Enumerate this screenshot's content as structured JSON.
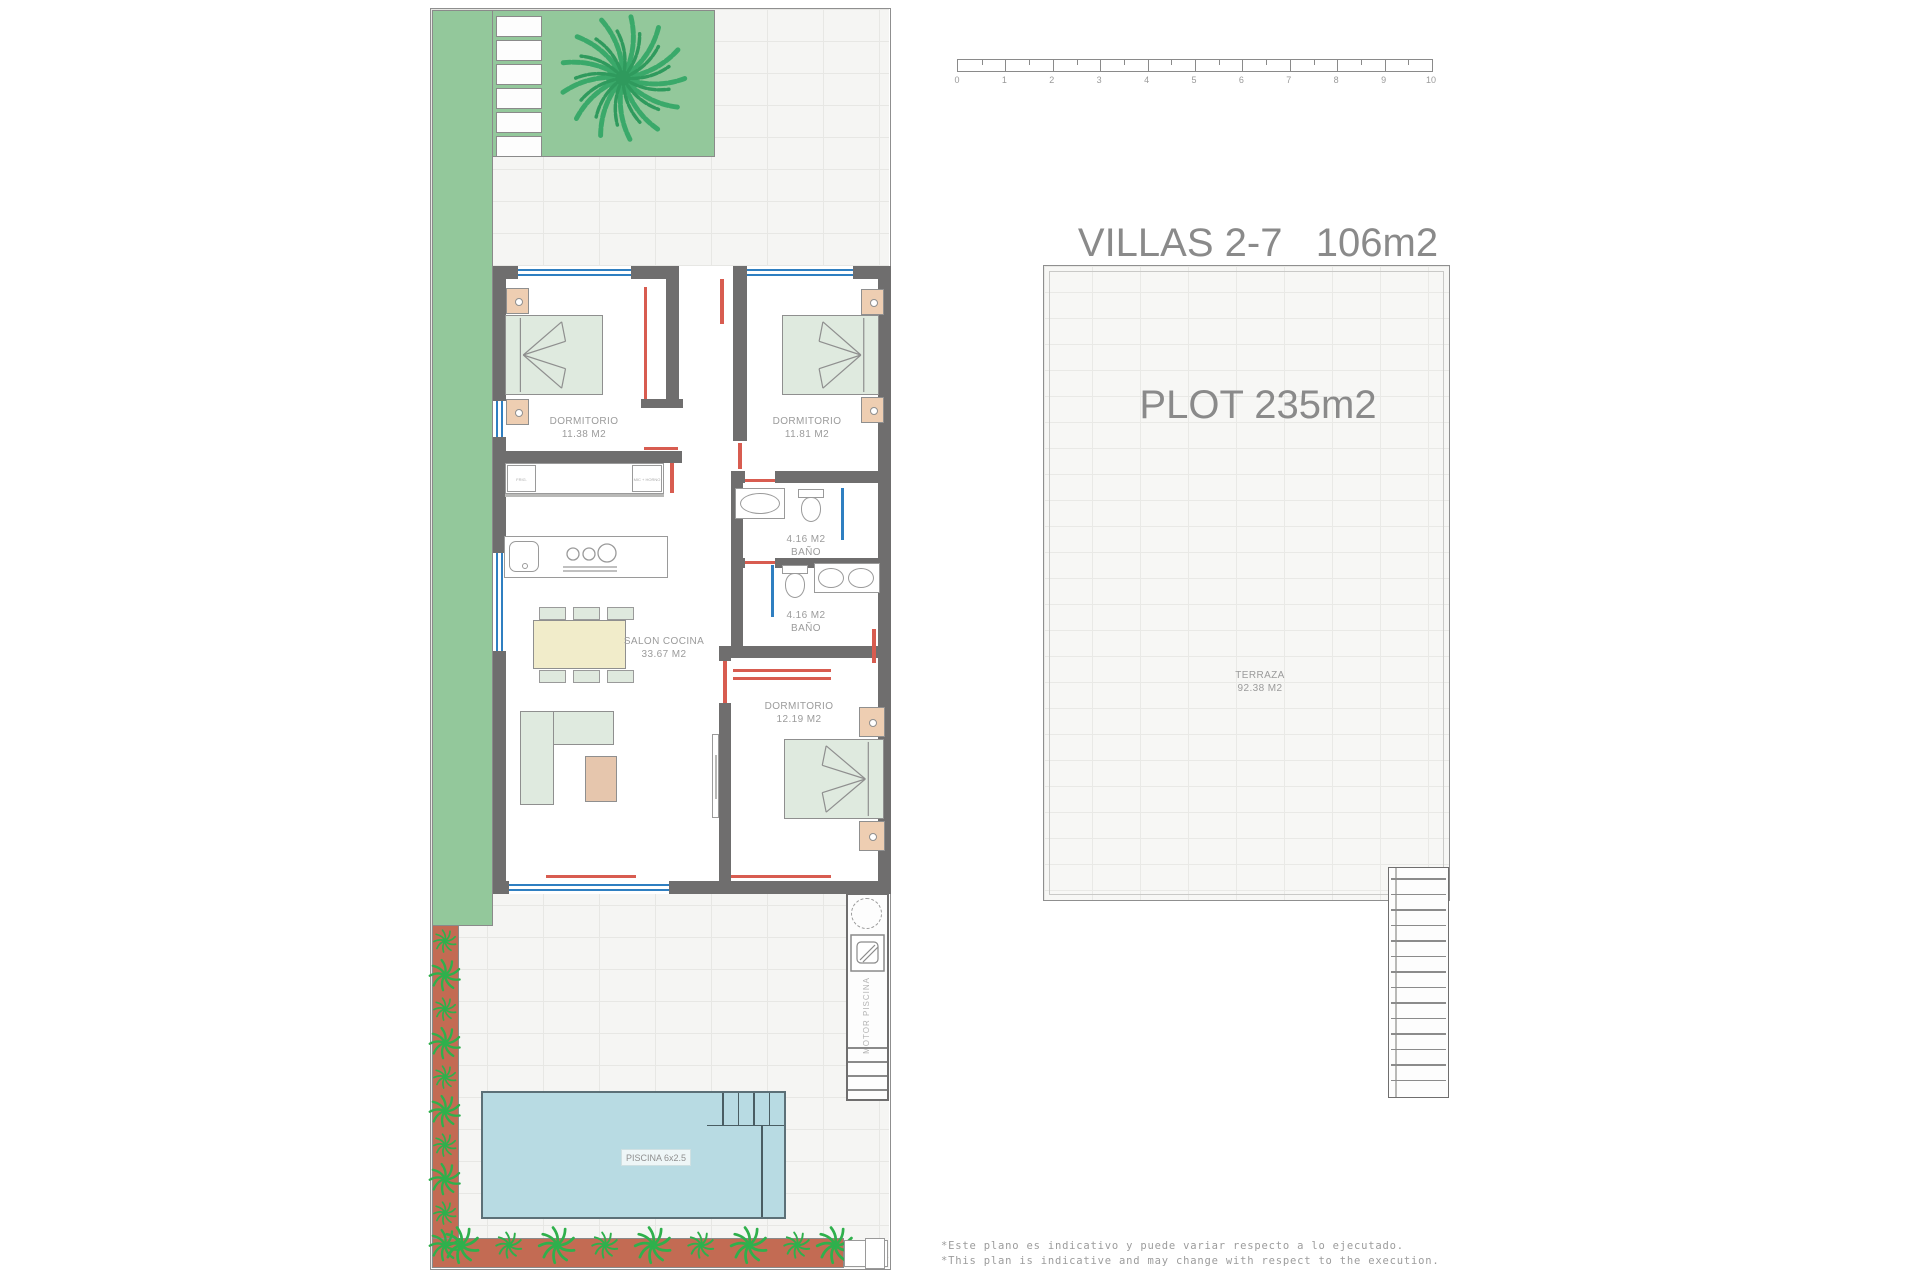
{
  "title": {
    "line1": "VILLAS 2-7   106m2",
    "line2": "PLOT 235m2"
  },
  "scale_bar": {
    "unit_labels": [
      "0",
      "1",
      "2",
      "3",
      "4",
      "5",
      "6",
      "7",
      "8",
      "9",
      "10"
    ]
  },
  "villa_plan": {
    "rooms": {
      "dormitorio1": {
        "name": "DORMITORIO",
        "area": "11.38 M2"
      },
      "dormitorio2": {
        "name": "DORMITORIO",
        "area": "11.81 M2"
      },
      "bano1": {
        "area": "4.16 M2",
        "name": "BAÑO"
      },
      "bano2": {
        "area": "4.16 M2",
        "name": "BAÑO"
      },
      "salon": {
        "name": "SALON COCINA",
        "area": "33.67 M2"
      },
      "dormitorio3": {
        "name": "DORMITORIO",
        "area": "12.19 M2"
      }
    },
    "kitchen": {
      "fridge_label": "FRIG.",
      "oven_label": "MIC + HORNO"
    },
    "outdoor": {
      "piscina_label": "PISCINA 6x2.5",
      "motor_label": "MOTOR PISCINA"
    }
  },
  "terrace_plan": {
    "name": "TERRAZA",
    "area": "92.38 M2"
  },
  "footnotes": {
    "line1": "*Este plano es indicativo y puede variar respecto a lo ejecutado.",
    "line2": "*This plan is indicative and may change with respect to the execution."
  },
  "colors": {
    "garden_green": "#93c89b",
    "palm_green": "#3aa96a",
    "planter_terracotta": "#c36b53",
    "plant_green": "#2fb04c",
    "pool_blue": "#b8dbe3",
    "wall_gray": "#6f6e6e",
    "door_red": "#d85c50",
    "window_blue": "#2f7fc1",
    "furniture_green": "#dfeadf",
    "wood_peach": "#eeceb2",
    "label_gray": "#9b9b9b"
  }
}
